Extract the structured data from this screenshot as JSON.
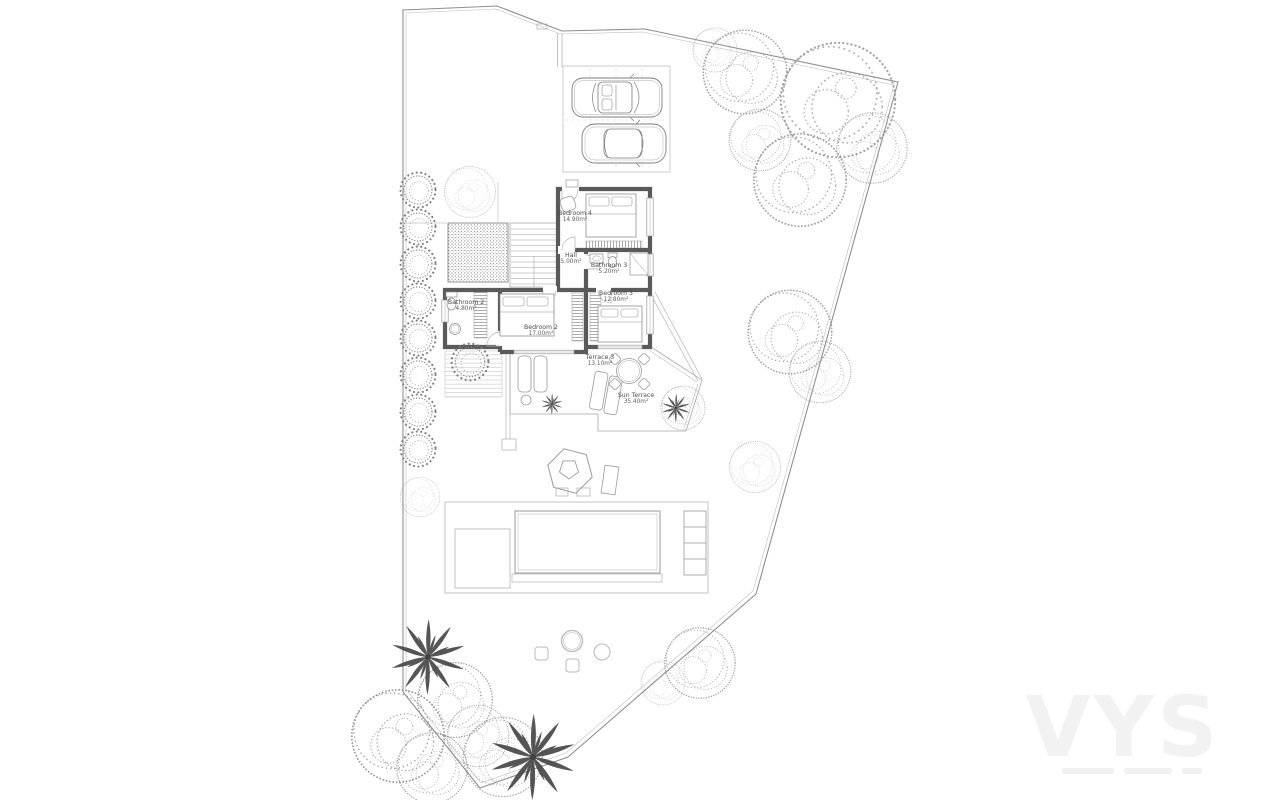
{
  "watermark": {
    "text": "VYS"
  },
  "plan": {
    "rooms": [
      {
        "id": "bedroom4",
        "name": "Bedroom 4",
        "area": "14.90m²"
      },
      {
        "id": "hall",
        "name": "Hall",
        "area": "5.00m²"
      },
      {
        "id": "bathroom3",
        "name": "Bathroom 3",
        "area": "5.20m²"
      },
      {
        "id": "bedroom3",
        "name": "Bedroom 3",
        "area": "12.80m²"
      },
      {
        "id": "bedroom2",
        "name": "Bedroom 2",
        "area": "17.00m²"
      },
      {
        "id": "bathroom2",
        "name": "Bathroom 2",
        "area": "4.80m²"
      },
      {
        "id": "terrace3",
        "name": "Terrace 3",
        "area": "13.10m²"
      },
      {
        "id": "sunterrace",
        "name": "Sun Terrace",
        "area": "35.40m²"
      }
    ],
    "colors": {
      "wall": "#5a5a5a",
      "thin_line": "#9a9a9a",
      "boundary": "#8f8f8f",
      "foliage": "#8a8a8a",
      "palm": "#3c3c3c",
      "label_text": "#4a4a4a",
      "watermark": "#f2f2f2"
    }
  }
}
